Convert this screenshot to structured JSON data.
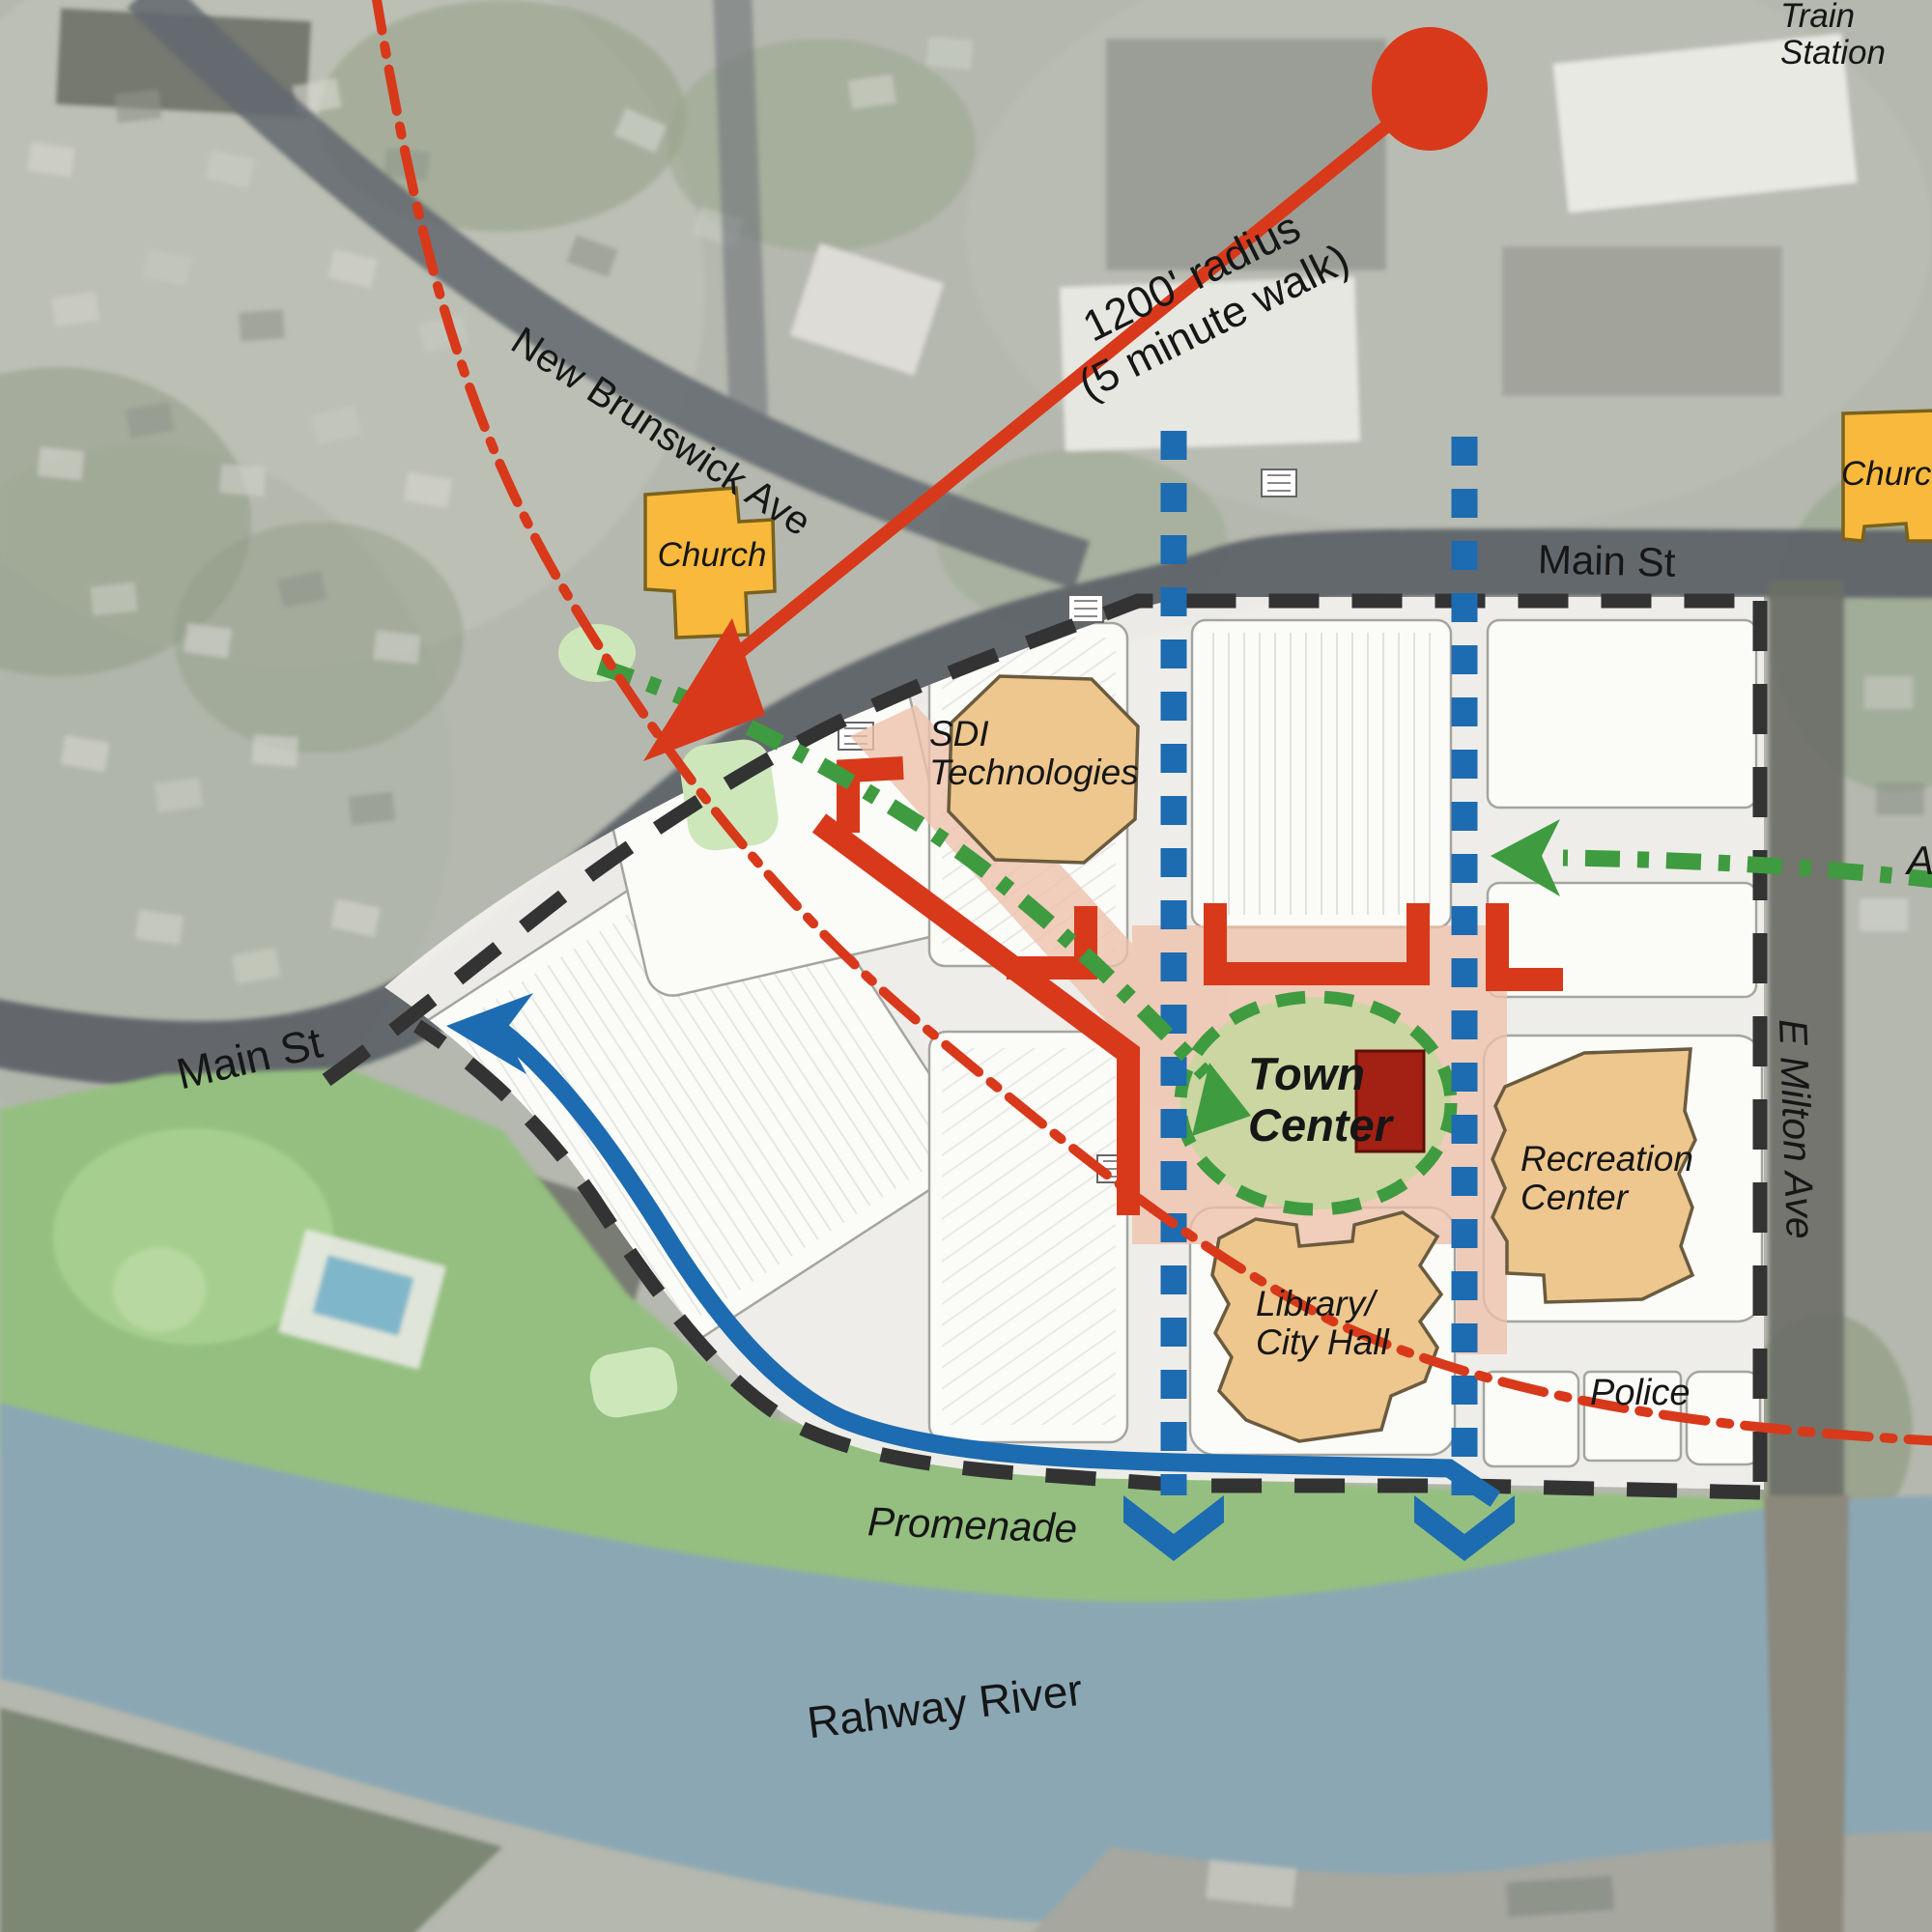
{
  "labels": {
    "train_station_line1": "Train",
    "train_station_line2": "Station",
    "radius_line1": "1200' radius",
    "radius_line2": "(5 minute walk)",
    "new_brunswick_ave": "New Brunswick Ave",
    "main_st_top": "Main St",
    "main_st_left": "Main St",
    "e_milton_ave": "E Milton Ave",
    "street_partial_right": "A",
    "promenade": "Promenade",
    "rahway_river": "Rahway River"
  },
  "places": {
    "church_left": "Church",
    "church_right": "Church",
    "sdi_line1": "SDI",
    "sdi_line2": "Technologies",
    "town_center_line1": "Town",
    "town_center_line2": "Center",
    "recreation_line1": "Recreation",
    "recreation_line2": "Center",
    "library_line1": "Library/",
    "library_line2": "City Hall",
    "police": "Police"
  },
  "colors": {
    "accent_red": "#d8391a",
    "dark_red_building": "#a32014",
    "route_green": "#3f9b3f",
    "line_blue": "#1d6bb0",
    "boundary_dark": "#333333",
    "building_tan": "#edc78e",
    "building_yellow": "#f8b93c",
    "plaza_pink": "#eec0aa",
    "oval_green_fill": "#cbd6a2",
    "park_green": "#94bf80",
    "river_blue": "#8ba7b4"
  }
}
